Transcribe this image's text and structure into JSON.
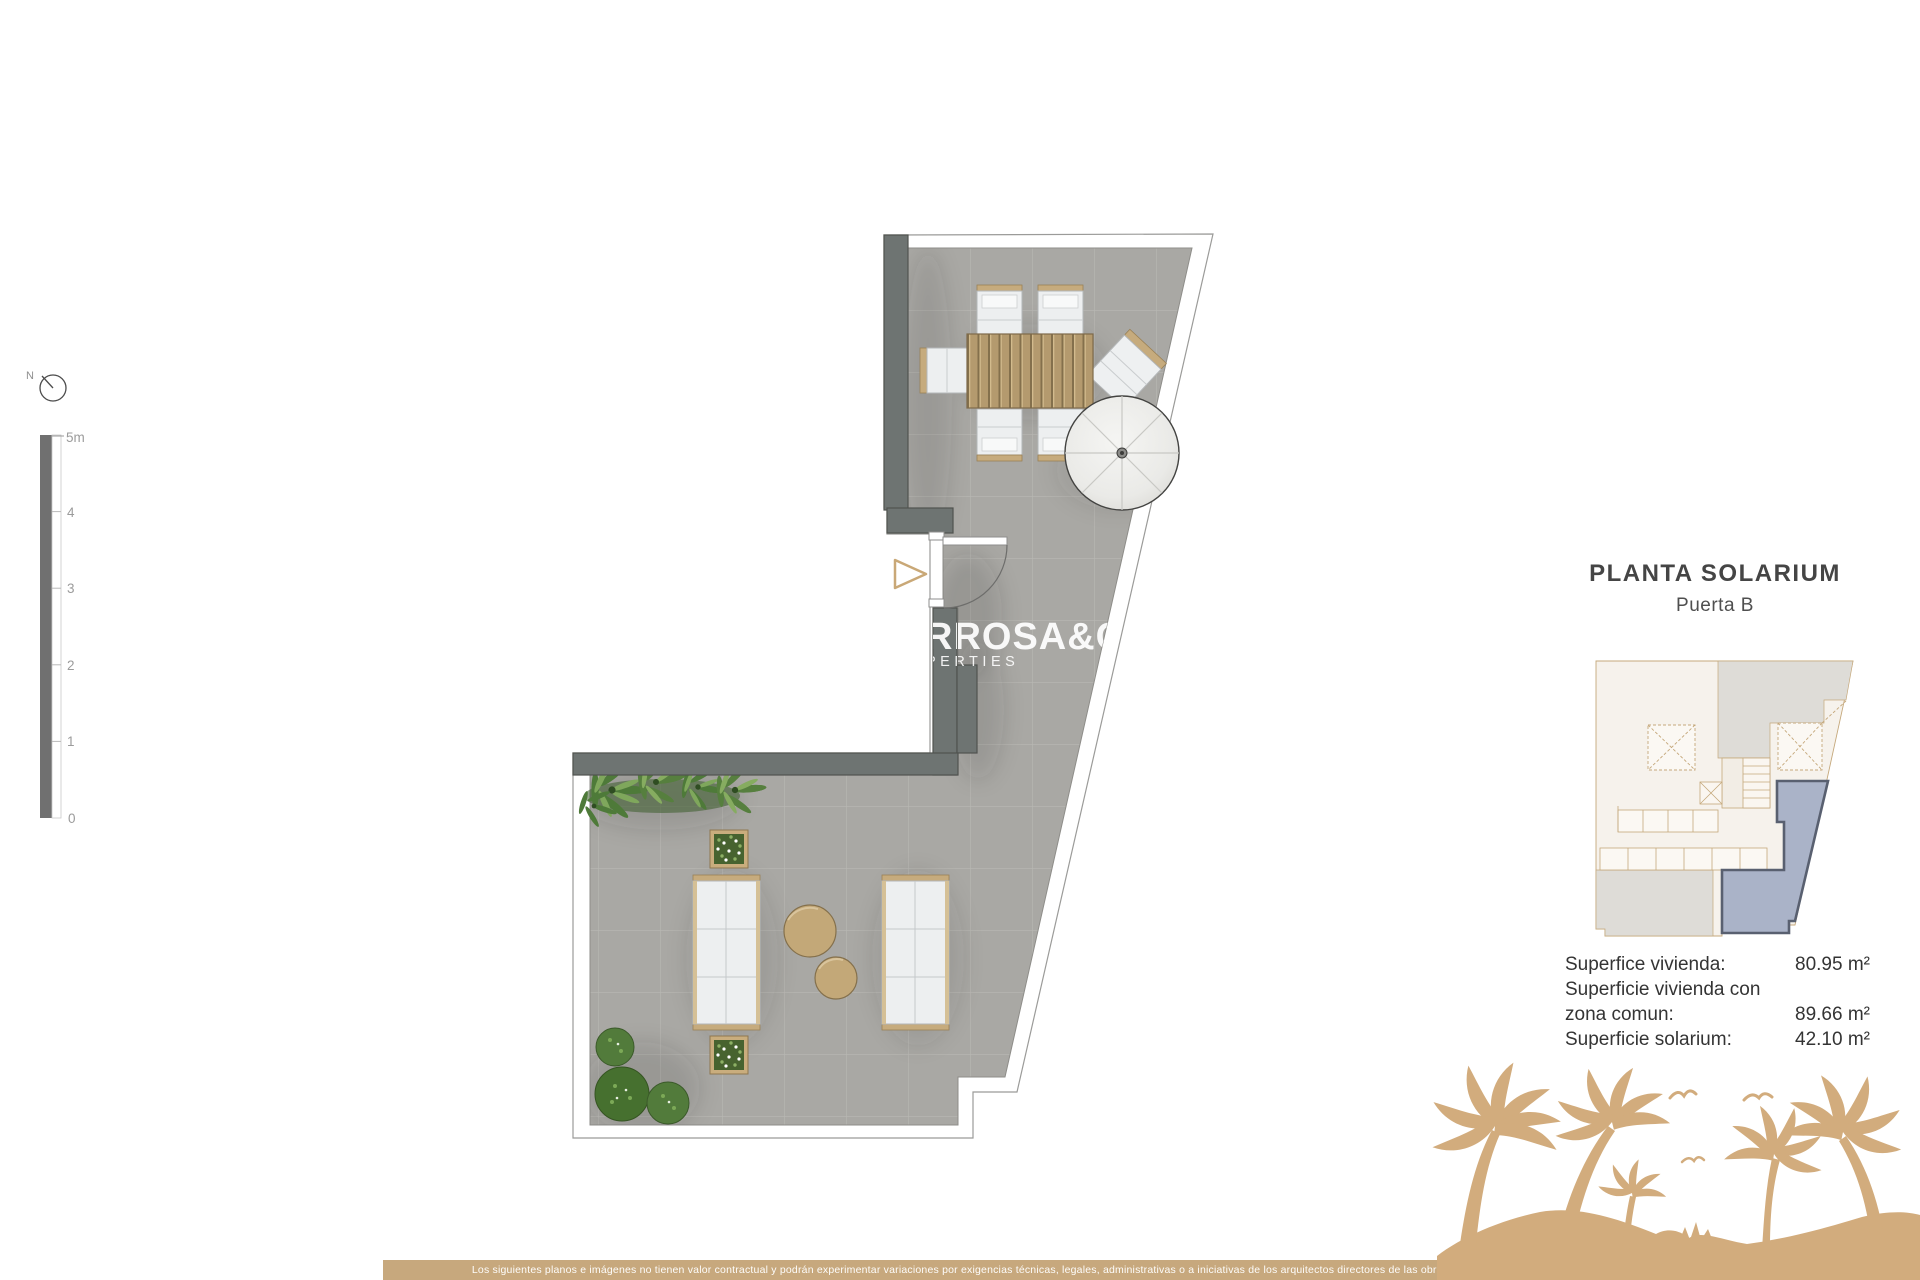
{
  "compass": {
    "label": "N"
  },
  "scale_bar": {
    "unit_labels": [
      "5m",
      "4",
      "3",
      "2",
      "1",
      "0"
    ]
  },
  "watermark": {
    "line1": "RROSA&CO",
    "line2": "PERTIES"
  },
  "title_block": {
    "title": "PLANTA SOLARIUM",
    "subtitle": "Puerta B"
  },
  "areas": {
    "lines": [
      {
        "label": "Superfice vivienda:",
        "value": "80.95 m²"
      },
      {
        "label": "Superficie vivienda con",
        "value": ""
      },
      {
        "label": "zona comun:",
        "value": "89.66 m²"
      },
      {
        "label": "Superficie solarium:",
        "value": "42.10 m²"
      }
    ]
  },
  "disclaimer": "Los siguientes planos e imágenes no tienen valor contractual y podrán experimentar variaciones por exigencias técnicas, legales, administrativas o a iniciativas de los arquitectos directores de las obras",
  "colors": {
    "accent_tan": "#c7a87d",
    "illustration_tan": "#d2ac7d",
    "highlight_blue": "#aab3c8",
    "wall_gray": "#6e7472",
    "floor_gray": "#a9a8a4"
  }
}
